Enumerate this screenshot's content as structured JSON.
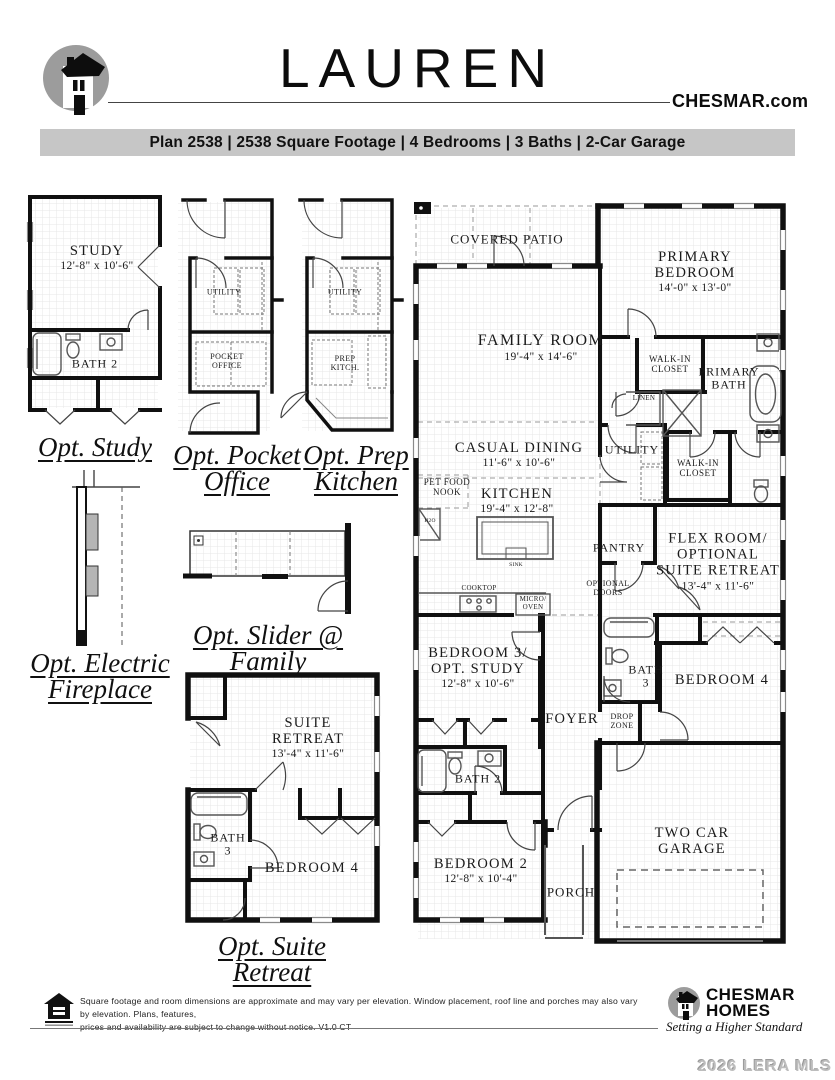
{
  "header": {
    "title": "LAUREN",
    "site": "CHESMAR.com"
  },
  "plan_bar": {
    "text": "Plan 2538 | 2538 Square Footage | 4 Bedrooms | 3 Baths | 2-Car Garage"
  },
  "options": {
    "study": {
      "caption": "Opt. Study",
      "room_name": "STUDY",
      "room_dims": "12'-8\" x 10'-6\"",
      "bath": "BATH 2"
    },
    "pocket_office": {
      "caption1": "Opt. Pocket",
      "caption2": "Office",
      "utility": "UTILITY",
      "line1": "POCKET",
      "line2": "OFFICE"
    },
    "prep_kitchen": {
      "caption1": "Opt. Prep",
      "caption2": "Kitchen",
      "utility": "UTILITY",
      "line1": "PREP",
      "line2": "KITCH."
    },
    "electric_fireplace": {
      "caption1": "Opt. Electric",
      "caption2": "Fireplace"
    },
    "slider_family": {
      "caption1": "Opt. Slider @",
      "caption2": "Family"
    },
    "suite_retreat": {
      "caption1": "Opt. Suite",
      "caption2": "Retreat",
      "line1": "SUITE",
      "line2": "RETREAT",
      "dims": "13'-4\" x 11'-6\"",
      "bath_line1": "BATH",
      "bath_line2": "3",
      "bedroom": "BEDROOM 4"
    }
  },
  "main_plan": {
    "covered_patio": {
      "name": "COVERED PATIO"
    },
    "primary_bedroom": {
      "line1": "PRIMARY",
      "line2": "BEDROOM",
      "dims": "14'-0\" x 13'-0\""
    },
    "family_room": {
      "name": "FAMILY ROOM",
      "dims": "19'-4\" x 14'-6\""
    },
    "walk_in_closet_1": {
      "line1": "WALK-IN",
      "line2": "CLOSET"
    },
    "primary_bath": {
      "line1": "PRIMARY",
      "line2": "BATH"
    },
    "linen": {
      "name": "LINEN"
    },
    "casual_dining": {
      "name": "CASUAL DINING",
      "dims": "11'-6\" x 10'-6\""
    },
    "utility": {
      "name": "UTILITY"
    },
    "walk_in_closet_2": {
      "line1": "WALK-IN",
      "line2": "CLOSET"
    },
    "pet_food_nook": {
      "line1": "PET FOOD",
      "line2": "NOOK"
    },
    "kitchen": {
      "name": "KITCHEN",
      "dims": "19'-4\" x 12'-8\""
    },
    "pantry": {
      "name": "PANTRY"
    },
    "flex_room": {
      "line1": "FLEX ROOM/",
      "line2": "OPTIONAL",
      "line3": "SUITE RETREAT",
      "dims": "13'-4\" x 11'-6\""
    },
    "optional_doors": {
      "line1": "OPTIONAL",
      "line2": "DOORS"
    },
    "cooktop": {
      "name": "COOKTOP"
    },
    "micro_oven": {
      "line1": "MICRO/",
      "line2": "OVEN"
    },
    "sink": {
      "name": "SINK"
    },
    "h2o": {
      "name": "H2O"
    },
    "bedroom3": {
      "line1": "BEDROOM 3/",
      "line2": "OPT. STUDY",
      "dims": "12'-8\" x 10'-6\""
    },
    "bath3": {
      "line1": "BATH",
      "line2": "3"
    },
    "bedroom4": {
      "name": "BEDROOM 4"
    },
    "foyer": {
      "name": "FOYER"
    },
    "drop_zone": {
      "line1": "DROP",
      "line2": "ZONE"
    },
    "bath2": {
      "name": "BATH 2"
    },
    "bedroom2": {
      "name": "BEDROOM 2",
      "dims": "12'-8\" x 10'-4\""
    },
    "porch": {
      "name": "PORCH"
    },
    "garage": {
      "line1": "TWO CAR",
      "line2": "GARAGE"
    }
  },
  "footer": {
    "disclaimer1": "Square footage and room dimensions are approximate and may vary per elevation. Window placement, roof line and porches may also vary by elevation. Plans, features,",
    "disclaimer2": "prices and availability are subject to change without notice. V1.0 CT",
    "brand1": "CHESMAR",
    "brand2": "HOMES",
    "tagline": "Setting a Higher Standard"
  },
  "watermark": {
    "text": "2026 LERA MLS"
  },
  "icons": {
    "header_logo": "chesmar-c-house-logo",
    "footer_logo": "chesmar-c-house-logo",
    "equal_housing": "equal-housing-icon"
  },
  "colors": {
    "bar_bg": "#c6c6c6",
    "logo_gray": "#9c9c9c",
    "wall": "#111111",
    "watermark_gray": "#bdbdbd"
  }
}
